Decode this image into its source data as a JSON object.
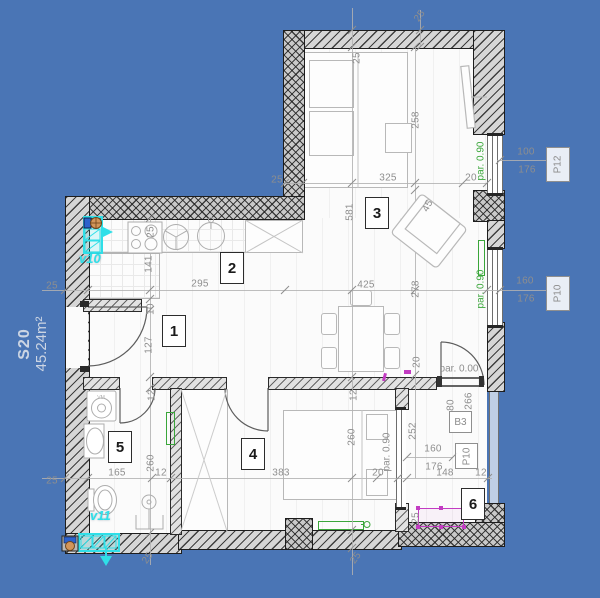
{
  "title": {
    "code": "S20",
    "area": "45.24m²"
  },
  "rooms": [
    [
      "1",
      162,
      315
    ],
    [
      "2",
      220,
      252
    ],
    [
      "3",
      365,
      197
    ],
    [
      "4",
      241,
      438
    ],
    [
      "5",
      108,
      431
    ],
    [
      "6",
      461,
      488
    ]
  ],
  "dims": [
    [
      "25",
      52,
      286,
      0
    ],
    [
      "295",
      200,
      284,
      0
    ],
    [
      "425",
      366,
      285,
      0
    ],
    [
      "325",
      388,
      178,
      0
    ],
    [
      "20",
      471,
      178,
      0
    ],
    [
      "25",
      277,
      180,
      0
    ],
    [
      "25",
      151,
      232,
      -90
    ],
    [
      "141",
      149,
      264,
      -90
    ],
    [
      "10",
      151,
      309,
      -90
    ],
    [
      "127",
      149,
      345,
      -90
    ],
    [
      "12",
      152,
      395,
      -90
    ],
    [
      "165",
      117,
      473,
      0
    ],
    [
      "12",
      161,
      473,
      0
    ],
    [
      "260",
      151,
      463,
      -90
    ],
    [
      "25",
      52,
      481,
      0
    ],
    [
      "581",
      350,
      212,
      -90
    ],
    [
      "258",
      416,
      120,
      -90
    ],
    [
      "45",
      428,
      206,
      -62
    ],
    [
      "25",
      357,
      58,
      -90
    ],
    [
      "25",
      420,
      16,
      -55
    ],
    [
      "278",
      416,
      289,
      -90
    ],
    [
      "20",
      417,
      362,
      -90
    ],
    [
      "12",
      354,
      395,
      -90
    ],
    [
      "260",
      352,
      437,
      -90
    ],
    [
      "383",
      281,
      473,
      0
    ],
    [
      "20",
      378,
      473,
      0
    ],
    [
      "148",
      445,
      473,
      0
    ],
    [
      "12",
      481,
      473,
      0
    ],
    [
      "252",
      413,
      431,
      -90
    ],
    [
      "80",
      451,
      405,
      -90
    ],
    [
      "266",
      469,
      401,
      -90
    ],
    [
      "160",
      433,
      449,
      0
    ],
    [
      "176",
      434,
      467,
      0
    ],
    [
      "25",
      416,
      518,
      -90
    ],
    [
      "100",
      526,
      152,
      0
    ],
    [
      "176",
      527,
      170,
      0
    ],
    [
      "160",
      525,
      281,
      0
    ],
    [
      "176",
      526,
      299,
      0
    ],
    [
      "25",
      148,
      558,
      -55
    ],
    [
      "25",
      356,
      558,
      -55
    ]
  ],
  "pars": [
    [
      "par. 0.90",
      "#3aa63a",
      481,
      161,
      -90
    ],
    [
      "par. 0.90",
      "#3aa63a",
      481,
      289,
      -90
    ],
    [
      "par. 0.90",
      "#8e8e8e",
      387,
      452,
      -90
    ],
    [
      "par. 0.00",
      "#8e8e8e",
      459,
      369,
      0
    ]
  ],
  "tags": [
    [
      "P12",
      546,
      147,
      22,
      33,
      true
    ],
    [
      "P10",
      546,
      276,
      22,
      33,
      true
    ],
    [
      "P10",
      455,
      443,
      21,
      24,
      true
    ],
    [
      "B3",
      449,
      411,
      21,
      20,
      false
    ]
  ],
  "vents": [
    [
      "v10",
      79,
      251
    ],
    [
      "v11",
      90,
      508
    ]
  ],
  "colors": {
    "background": "#4a75b5",
    "annotation_green": "#3aa63a",
    "annotation_cyan": "#2fdfe8",
    "annotation_magenta": "#c23cc2",
    "dimension_gray": "#8e8e8e"
  }
}
